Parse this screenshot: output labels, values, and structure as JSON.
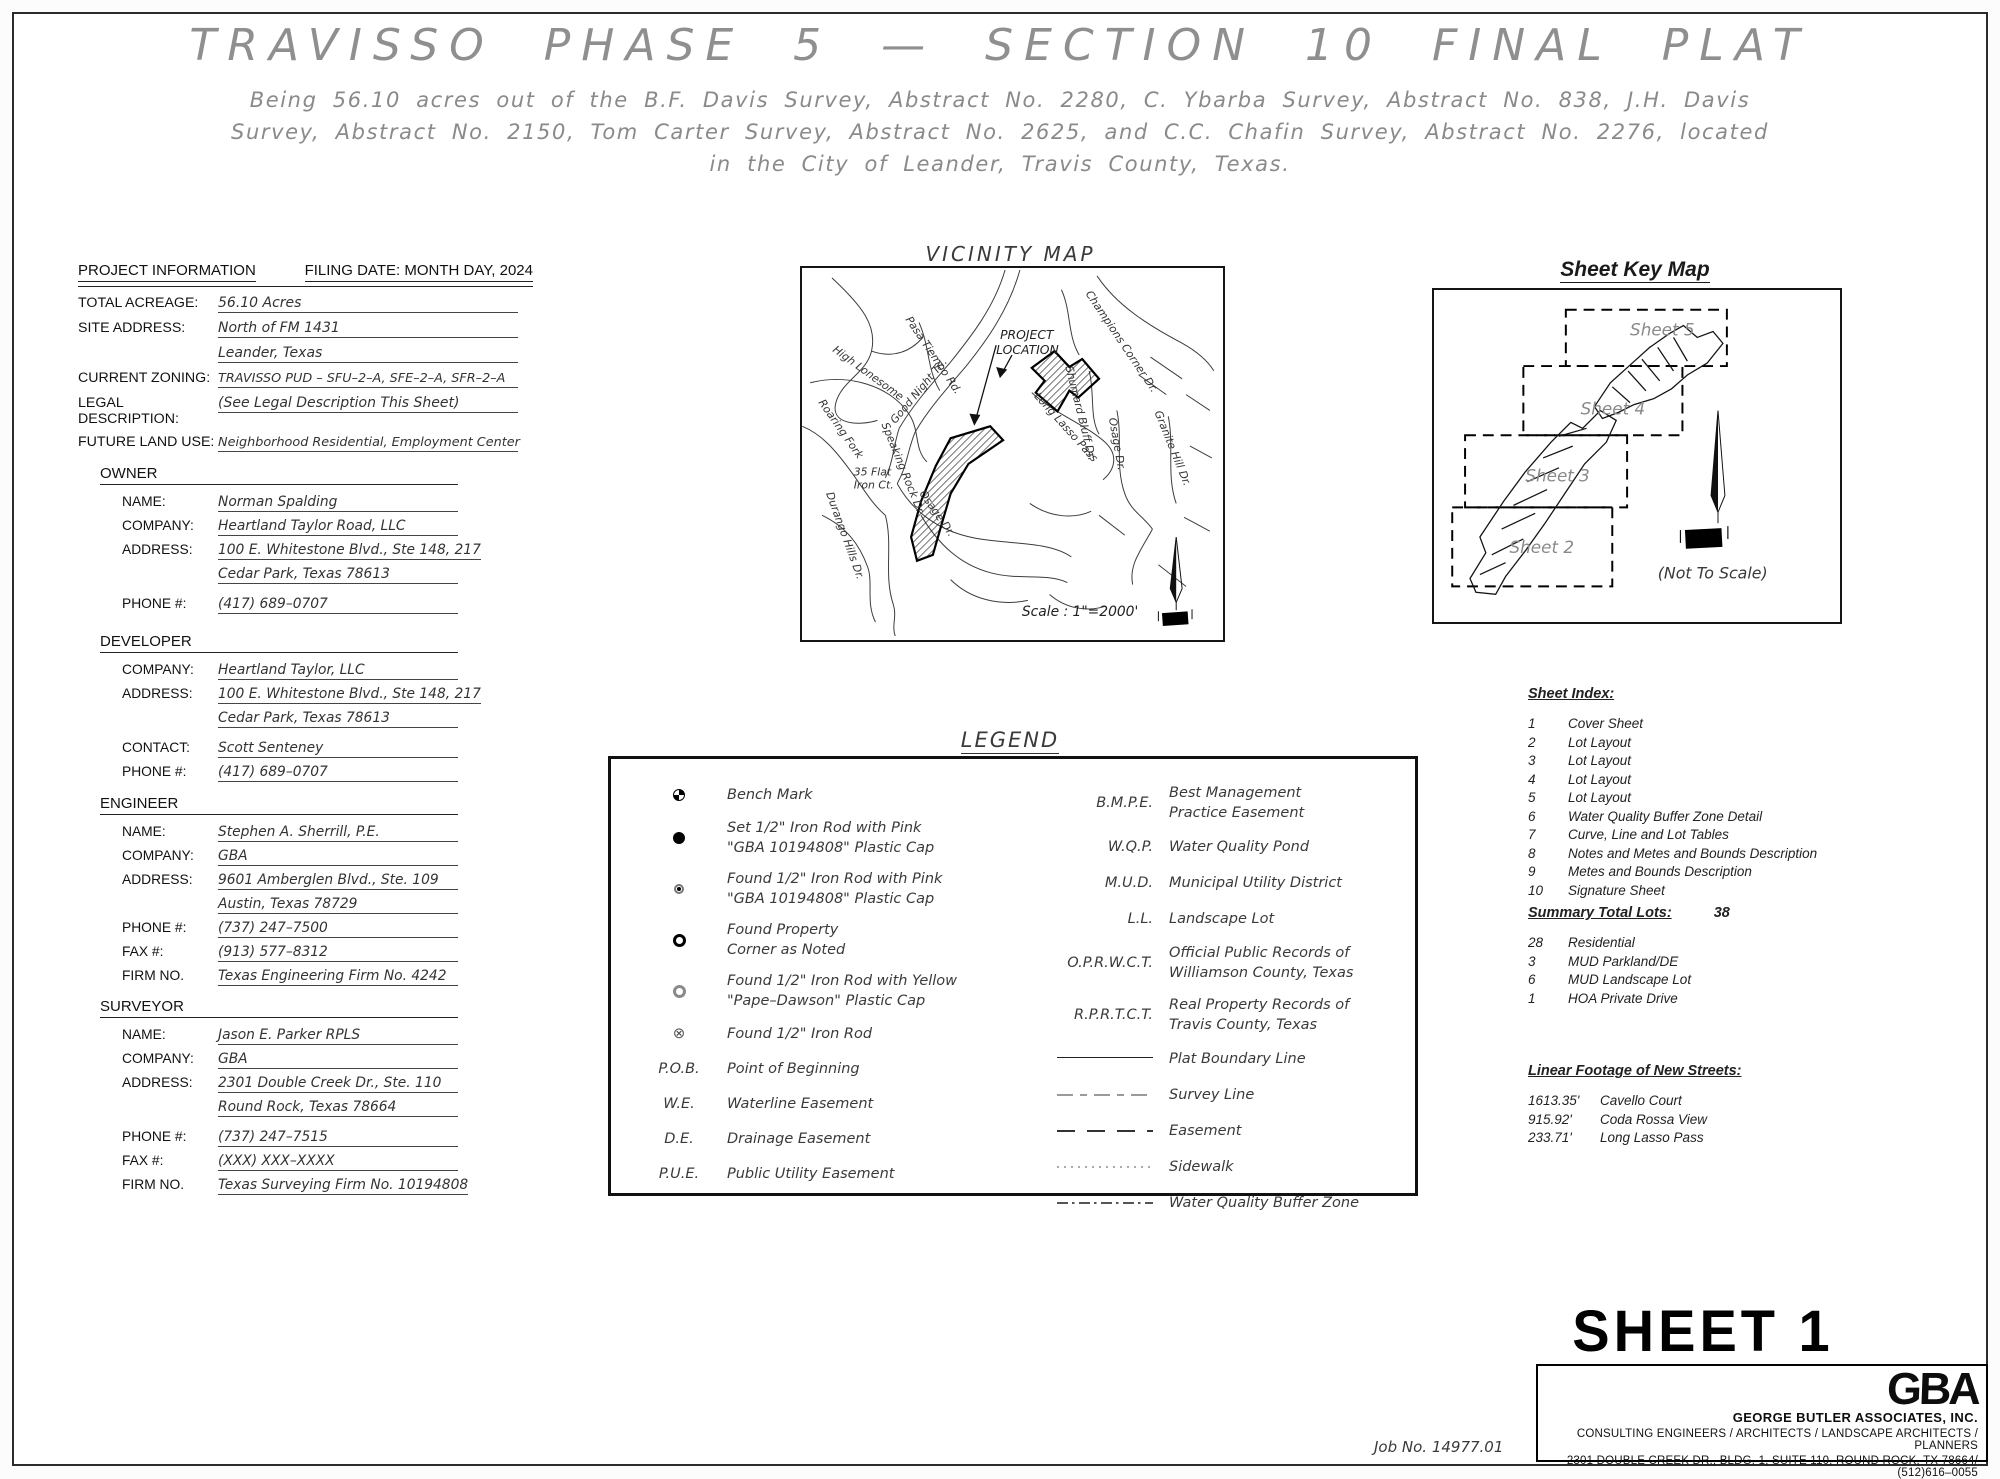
{
  "page": {
    "title": "TRAVISSO PHASE 5 — SECTION 10 FINAL PLAT",
    "subtitle_line1": "Being 56.10 acres out of the B.F. Davis Survey, Abstract No. 2280, C. Ybarba Survey, Abstract No. 838, J.H. Davis",
    "subtitle_line2": "Survey, Abstract No. 2150, Tom Carter Survey, Abstract No. 2625, and C.C. Chafin Survey, Abstract No. 2276,  located",
    "subtitle_line3": "in the City of Leander, Travis County, Texas."
  },
  "project_info": {
    "header": "PROJECT INFORMATION",
    "filing_date": "FILING DATE: MONTH DAY, 2024",
    "fields": [
      {
        "label": "TOTAL ACREAGE:",
        "value": "56.10 Acres"
      },
      {
        "label": "SITE ADDRESS:",
        "value": "North of FM 1431"
      },
      {
        "label": "",
        "value": "Leander, Texas"
      },
      {
        "label": "CURRENT ZONING:",
        "value": "TRAVISSO PUD – SFU–2–A, SFE–2–A, SFR–2–A"
      },
      {
        "label": "LEGAL DESCRIPTION:",
        "value": "(See Legal Description This Sheet)"
      },
      {
        "label": "FUTURE LAND USE:",
        "value": "Neighborhood Residential, Employment Center"
      }
    ]
  },
  "owner": {
    "header": "OWNER",
    "rows": [
      {
        "label": "NAME:",
        "value": "Norman Spalding"
      },
      {
        "label": "COMPANY:",
        "value": "Heartland Taylor Road, LLC"
      },
      {
        "label": "ADDRESS:",
        "value": "100 E. Whitestone Blvd., Ste 148, 217"
      },
      {
        "label": "",
        "value": "Cedar Park, Texas 78613"
      },
      {
        "label": "PHONE #:",
        "value": "(417) 689–0707"
      }
    ]
  },
  "developer": {
    "header": "DEVELOPER",
    "rows": [
      {
        "label": "COMPANY:",
        "value": "Heartland Taylor, LLC"
      },
      {
        "label": "ADDRESS:",
        "value": "100 E. Whitestone Blvd., Ste 148, 217"
      },
      {
        "label": "",
        "value": "Cedar Park, Texas 78613"
      },
      {
        "label": "CONTACT:",
        "value": "Scott Senteney"
      },
      {
        "label": "PHONE #:",
        "value": "(417) 689–0707"
      }
    ]
  },
  "engineer": {
    "header": "ENGINEER",
    "rows": [
      {
        "label": "NAME:",
        "value": "Stephen A. Sherrill, P.E."
      },
      {
        "label": "COMPANY:",
        "value": "GBA"
      },
      {
        "label": "ADDRESS:",
        "value": "9601 Amberglen Blvd., Ste. 109"
      },
      {
        "label": "",
        "value": "Austin, Texas 78729"
      },
      {
        "label": "PHONE #:",
        "value": "(737) 247–7500"
      },
      {
        "label": "FAX #:",
        "value": "(913) 577–8312"
      },
      {
        "label": "FIRM NO.",
        "value": "Texas Engineering Firm No. 4242"
      }
    ]
  },
  "surveyor": {
    "header": "SURVEYOR",
    "rows": [
      {
        "label": "NAME:",
        "value": "Jason E. Parker RPLS"
      },
      {
        "label": "COMPANY:",
        "value": "GBA"
      },
      {
        "label": "ADDRESS:",
        "value": "2301 Double Creek Dr., Ste. 110"
      },
      {
        "label": "",
        "value": "Round Rock, Texas 78664"
      },
      {
        "label": "PHONE #:",
        "value": "(737) 247–7515"
      },
      {
        "label": "FAX #:",
        "value": "(XXX) XXX–XXXX"
      },
      {
        "label": "FIRM NO.",
        "value": "Texas Surveying Firm No. 10194808"
      }
    ]
  },
  "vicinity_map": {
    "title": "VICINITY MAP",
    "project_label_1": "PROJECT",
    "project_label_2": "LOCATION",
    "scale": "Scale : 1\"=2000'",
    "streets": {
      "pasa": "Pasa Tiempo Rd.",
      "high": "High Lonesome",
      "good": "Good Night Trl.",
      "roaring": "Roaring Fork",
      "speaking": "Speaking Rock Dr.",
      "flat1": "35 Flat",
      "flat2": "Iron Ct.",
      "durango": "Durango Hills Dr.",
      "osage_bottom": "Osage Dr.",
      "osage_right": "Osage Dr.",
      "lasso": "Long Lasso Pass",
      "shumard": "Shumard Bluff Dr.",
      "champions": "Champions Corner Dr.",
      "granite": "Granite Hill Dr."
    }
  },
  "sheet_key_map": {
    "title": "Sheet Key Map",
    "sheets": [
      "Sheet 5",
      "Sheet 4",
      "Sheet 3",
      "Sheet 2"
    ],
    "not_to_scale": "(Not To Scale)"
  },
  "legend": {
    "title": "LEGEND",
    "left": [
      {
        "sym": "benchmark",
        "line1": "Bench Mark",
        "line2": ""
      },
      {
        "sym": "set-iron-rod",
        "line1": "Set 1/2\" Iron Rod with Pink",
        "line2": "\"GBA 10194808\" Plastic Cap"
      },
      {
        "sym": "found-iron-rod-pink",
        "line1": "Found 1/2\" Iron Rod with Pink",
        "line2": "\"GBA 10194808\" Plastic Cap"
      },
      {
        "sym": "found-property-corner",
        "line1": "Found Property",
        "line2": "Corner as Noted"
      },
      {
        "sym": "found-iron-rod-yellow",
        "line1": "Found 1/2\" Iron Rod with Yellow",
        "line2": "\"Pape–Dawson\" Plastic Cap"
      },
      {
        "sym": "found-iron-rod",
        "glyph": "⊗",
        "line1": "Found 1/2\" Iron Rod",
        "line2": ""
      },
      {
        "abbr": "P.O.B.",
        "line1": "Point of Beginning"
      },
      {
        "abbr": "W.E.",
        "line1": "Waterline Easement"
      },
      {
        "abbr": "D.E.",
        "line1": "Drainage Easement"
      },
      {
        "abbr": "P.U.E.",
        "line1": "Public Utility Easement"
      }
    ],
    "right": [
      {
        "abbr": "B.M.P.E.",
        "line1": "Best Management",
        "line2": "Practice Easement"
      },
      {
        "abbr": "W.Q.P.",
        "line1": "Water Quality Pond"
      },
      {
        "abbr": "M.U.D.",
        "line1": "Municipal Utility District"
      },
      {
        "abbr": "L.L.",
        "line1": "Landscape Lot"
      },
      {
        "abbr": "O.P.R.W.C.T.",
        "line1": "Official Public Records of",
        "line2": "Williamson County, Texas"
      },
      {
        "abbr": "R.P.R.T.C.T.",
        "line1": "Real Property Records of",
        "line2": "Travis County, Texas"
      },
      {
        "line": "plat-boundary-line",
        "line1": "Plat Boundary Line"
      },
      {
        "line": "survey-line",
        "line1": "Survey Line"
      },
      {
        "line": "easement-line",
        "line1": "Easement"
      },
      {
        "line": "sidewalk-line",
        "line1": "Sidewalk"
      },
      {
        "line": "water-quality-buffer-zone-line",
        "line1": "Water Quality Buffer Zone"
      }
    ]
  },
  "sheet_index": {
    "title": "Sheet Index:",
    "rows": [
      {
        "num": "1",
        "label": "Cover Sheet"
      },
      {
        "num": "2",
        "label": "Lot Layout"
      },
      {
        "num": "3",
        "label": "Lot Layout"
      },
      {
        "num": "4",
        "label": "Lot Layout"
      },
      {
        "num": "5",
        "label": "Lot Layout"
      },
      {
        "num": "6",
        "label": "Water Quality Buffer Zone Detail"
      },
      {
        "num": "7",
        "label": "Curve, Line and Lot Tables"
      },
      {
        "num": "8",
        "label": "Notes and Metes and Bounds Description"
      },
      {
        "num": "9",
        "label": "Metes and Bounds Description"
      },
      {
        "num": "10",
        "label": "Signature Sheet"
      }
    ]
  },
  "summary": {
    "title": "Summary Total Lots:",
    "total": "38",
    "rows": [
      {
        "num": "28",
        "label": "Residential"
      },
      {
        "num": "3",
        "label": "MUD Parkland/DE"
      },
      {
        "num": "6",
        "label": "MUD Landscape Lot"
      },
      {
        "num": "1",
        "label": "HOA Private Drive"
      }
    ]
  },
  "linear_footage": {
    "title": "Linear Footage of New Streets:",
    "rows": [
      {
        "len": "1613.35'",
        "name": "Cavello Court"
      },
      {
        "len": "915.92'",
        "name": "Coda Rossa View"
      },
      {
        "len": "233.71'",
        "name": "Long Lasso Pass"
      }
    ]
  },
  "footer": {
    "sheet_label": "SHEET 1",
    "job_no": "Job No. 14977.01",
    "logo": "GBA",
    "company": "GEORGE BUTLER ASSOCIATES, INC.",
    "line1": "CONSULTING ENGINEERS / ARCHITECTS / LANDSCAPE ARCHITECTS / PLANNERS",
    "line2": "2301 DOUBLE CREEK DR., BLDG. 1, SUITE 110, ROUND ROCK, TX 78664/ (512)616–0055"
  }
}
